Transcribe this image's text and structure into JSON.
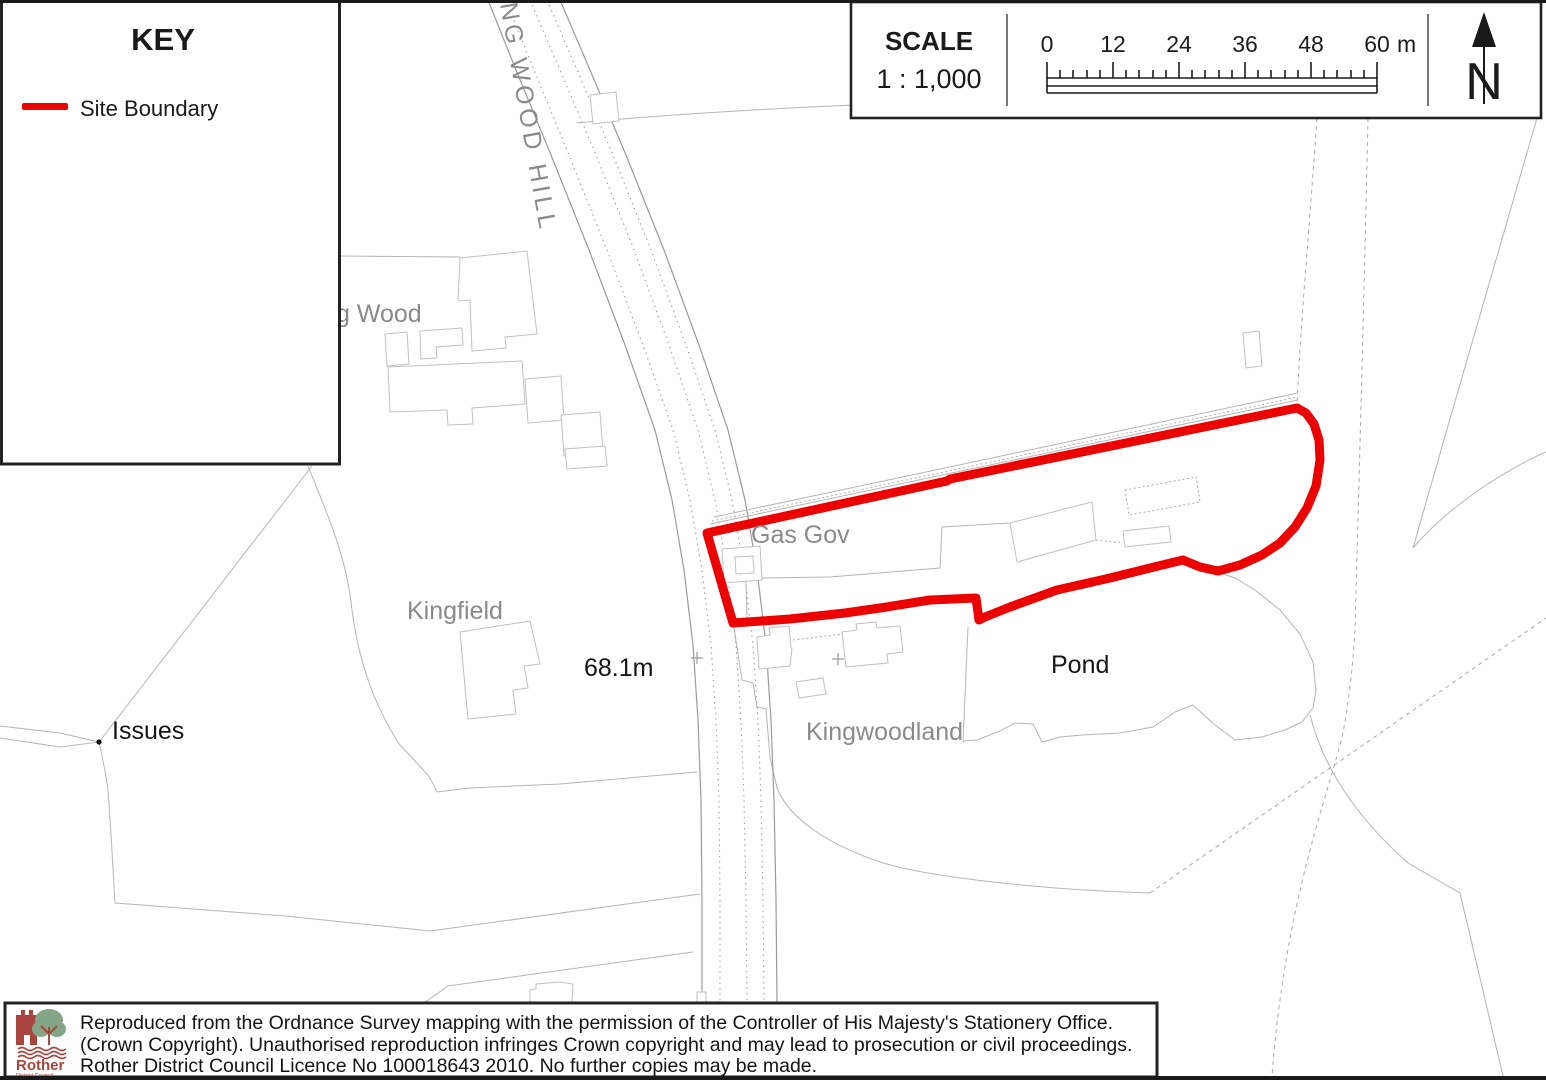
{
  "key": {
    "title": "KEY",
    "items": [
      {
        "label": "Site Boundary",
        "swatch_color": "#ed0000"
      }
    ]
  },
  "scale": {
    "title": "SCALE",
    "ratio": "1 : 1,000",
    "ticks": [
      "0",
      "12",
      "24",
      "36",
      "48",
      "60"
    ],
    "unit": "m",
    "north": "N"
  },
  "map": {
    "labels": {
      "road": "NG WOOD HILL",
      "wood": "g Wood",
      "gas_gov": "Gas Gov",
      "kingfield": "Kingfield",
      "spot_height": "68.1m",
      "issues": "Issues",
      "pond": "Pond",
      "kingwoodland": "Kingwoodland"
    },
    "site_boundary_color": "#ed0000",
    "map_line_color": "#b5b5b5",
    "label_gray_color": "#8a8a8a"
  },
  "footer": {
    "logo_title": "Rother",
    "logo_subtitle": "District Council",
    "logo_red": "#a9443e",
    "logo_green": "#84a686",
    "lines": [
      "Reproduced from the Ordnance Survey mapping with the permission of the Controller of His Majesty's Stationery Office.",
      "(Crown Copyright). Unauthorised reproduction infringes Crown copyright and may lead to prosecution or civil proceedings.",
      "Rother District Council Licence No 100018643 2010. No further copies may be made."
    ]
  }
}
